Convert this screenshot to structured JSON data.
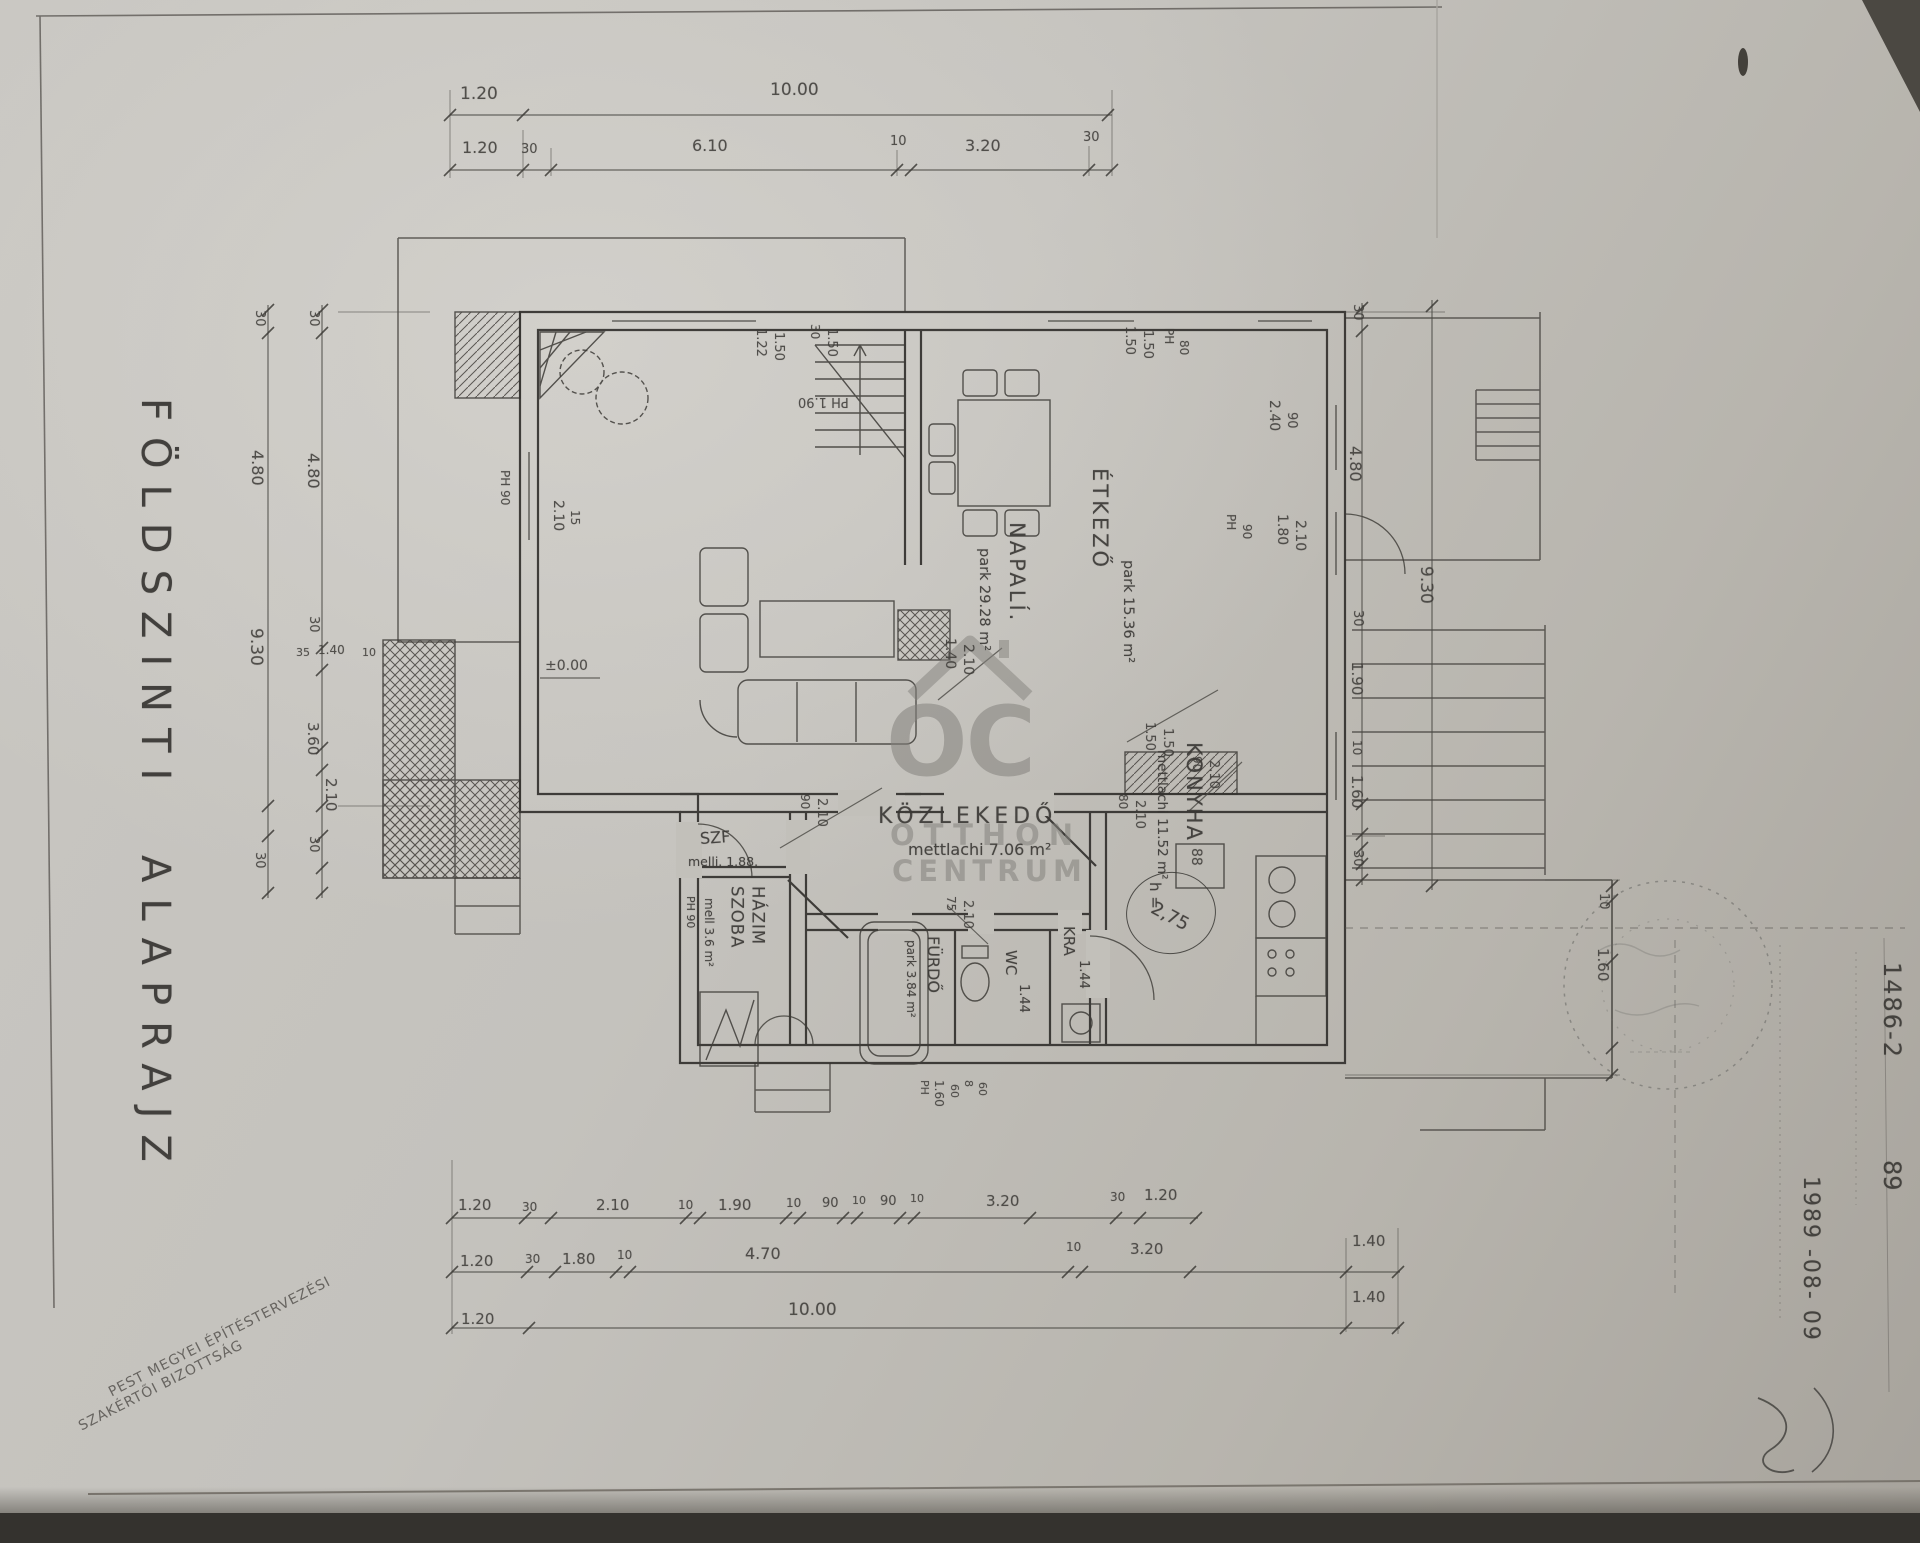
{
  "document": {
    "plan_title": "FÖLDSZINTI ALAPRAJZ",
    "committee_line1": "PEST MEGYEI ÉPÍTÉSTERVEZÉSI",
    "committee_line2": "SZAKÉRTŐI BIZOTTSÁG",
    "doc_number": "1486-2",
    "doc_number_suffix": "89",
    "date": "1989 -08- 09"
  },
  "watermark": {
    "logo": "OC",
    "line1": "OTTHON",
    "line2": "CENTRUM"
  },
  "rooms": {
    "napali": {
      "name": "NAPALÍ.",
      "area": "park 29.28 m²"
    },
    "etkezo": {
      "name": "ÉTKEZŐ",
      "area": "park 15.36 m²"
    },
    "konyha": {
      "name": "KONYHA",
      "area": "mettlachi 11.52 m²"
    },
    "kozlekedo": {
      "name": "KÖZLEKEDŐ",
      "area": "mettlachi 7.06 m²"
    },
    "furdo": {
      "name": "FÜRDŐ",
      "area": "park 3.84 m²"
    },
    "szf": {
      "name": "SZF",
      "area": "melli. 1.88."
    },
    "hazim_szoba": {
      "name": "HÁZIM SZOBA",
      "area": "mell 3.6 m²",
      "extra": "PH 90"
    },
    "wc": {
      "name": "WC",
      "area": "1.44"
    },
    "kamra": {
      "name": "KRA",
      "area": "1.44"
    }
  },
  "height_marker": {
    "label": "h =",
    "value": "2,75"
  },
  "annotations": [
    {
      "t": "1.20",
      "x": 460,
      "y": 84,
      "s": 17
    },
    {
      "t": "10.00",
      "x": 770,
      "y": 80,
      "s": 17
    },
    {
      "t": "1.20",
      "x": 462,
      "y": 138,
      "s": 16
    },
    {
      "t": "30",
      "x": 521,
      "y": 142,
      "s": 13
    },
    {
      "t": "6.10",
      "x": 692,
      "y": 136,
      "s": 16
    },
    {
      "t": "10",
      "x": 890,
      "y": 134,
      "s": 13
    },
    {
      "t": "3.20",
      "x": 965,
      "y": 136,
      "s": 16
    },
    {
      "t": "30",
      "x": 1083,
      "y": 130,
      "s": 13
    },
    {
      "t": "30",
      "x": 252,
      "y": 310,
      "r": 90,
      "s": 13
    },
    {
      "t": "30",
      "x": 306,
      "y": 310,
      "r": 90,
      "s": 13
    },
    {
      "t": "4.80",
      "x": 248,
      "y": 450,
      "r": 90,
      "s": 16
    },
    {
      "t": "4.80",
      "x": 304,
      "y": 453,
      "r": 90,
      "s": 16
    },
    {
      "t": "9.30",
      "x": 246,
      "y": 628,
      "r": 90,
      "s": 17
    },
    {
      "t": "30",
      "x": 306,
      "y": 616,
      "r": 90,
      "s": 13
    },
    {
      "t": "35",
      "x": 296,
      "y": 646,
      "s": 11
    },
    {
      "t": "1.40",
      "x": 318,
      "y": 643,
      "s": 12
    },
    {
      "t": "10",
      "x": 362,
      "y": 646,
      "s": 11
    },
    {
      "t": "3.60",
      "x": 304,
      "y": 722,
      "r": 90,
      "s": 15
    },
    {
      "t": "2.10",
      "x": 322,
      "y": 778,
      "r": 90,
      "s": 15
    },
    {
      "t": "30",
      "x": 252,
      "y": 852,
      "r": 90,
      "s": 13
    },
    {
      "t": "30",
      "x": 306,
      "y": 836,
      "r": 90,
      "s": 13
    },
    {
      "t": "30",
      "x": 1350,
      "y": 304,
      "r": 90,
      "s": 13
    },
    {
      "t": "4.80",
      "x": 1346,
      "y": 446,
      "r": 90,
      "s": 16
    },
    {
      "t": "30",
      "x": 1350,
      "y": 610,
      "r": 90,
      "s": 13
    },
    {
      "t": "1.90",
      "x": 1348,
      "y": 662,
      "r": 90,
      "s": 15
    },
    {
      "t": "10",
      "x": 1350,
      "y": 740,
      "r": 90,
      "s": 12
    },
    {
      "t": "1.60",
      "x": 1348,
      "y": 775,
      "r": 90,
      "s": 15
    },
    {
      "t": "30",
      "x": 1350,
      "y": 850,
      "r": 90,
      "s": 13
    },
    {
      "t": "9.30",
      "x": 1416,
      "y": 566,
      "r": 90,
      "s": 17
    },
    {
      "t": "10",
      "x": 1596,
      "y": 893,
      "r": 90,
      "s": 13
    },
    {
      "t": "1.60",
      "x": 1594,
      "y": 948,
      "r": 90,
      "s": 15
    },
    {
      "t": "1.20",
      "x": 458,
      "y": 1196,
      "s": 15
    },
    {
      "t": "30",
      "x": 522,
      "y": 1200,
      "s": 12
    },
    {
      "t": "2.10",
      "x": 596,
      "y": 1196,
      "s": 15
    },
    {
      "t": "10",
      "x": 678,
      "y": 1198,
      "s": 12
    },
    {
      "t": "1.90",
      "x": 718,
      "y": 1196,
      "s": 15
    },
    {
      "t": "10",
      "x": 786,
      "y": 1196,
      "s": 12
    },
    {
      "t": "90",
      "x": 822,
      "y": 1196,
      "s": 13
    },
    {
      "t": "10",
      "x": 852,
      "y": 1194,
      "s": 11
    },
    {
      "t": "90",
      "x": 880,
      "y": 1194,
      "s": 13
    },
    {
      "t": "10",
      "x": 910,
      "y": 1192,
      "s": 11
    },
    {
      "t": "3.20",
      "x": 986,
      "y": 1192,
      "s": 15
    },
    {
      "t": "30",
      "x": 1110,
      "y": 1190,
      "s": 12
    },
    {
      "t": "1.20",
      "x": 1144,
      "y": 1186,
      "s": 15
    },
    {
      "t": "1.20",
      "x": 460,
      "y": 1252,
      "s": 15
    },
    {
      "t": "30",
      "x": 525,
      "y": 1252,
      "s": 12
    },
    {
      "t": "1.80",
      "x": 562,
      "y": 1250,
      "s": 15
    },
    {
      "t": "10",
      "x": 617,
      "y": 1248,
      "s": 12
    },
    {
      "t": "4.70",
      "x": 745,
      "y": 1244,
      "s": 16
    },
    {
      "t": "10",
      "x": 1066,
      "y": 1240,
      "s": 12
    },
    {
      "t": "3.20",
      "x": 1130,
      "y": 1240,
      "s": 15
    },
    {
      "t": "1.40",
      "x": 1352,
      "y": 1232,
      "s": 15
    },
    {
      "t": "1.20",
      "x": 461,
      "y": 1310,
      "s": 15
    },
    {
      "t": "10.00",
      "x": 788,
      "y": 1300,
      "s": 17
    },
    {
      "t": "1.40",
      "x": 1352,
      "y": 1288,
      "s": 15
    },
    {
      "t": "1.22",
      "x": 753,
      "y": 328,
      "r": 90,
      "s": 13
    },
    {
      "t": "1.50",
      "x": 771,
      "y": 332,
      "r": 90,
      "s": 13
    },
    {
      "t": "30",
      "x": 808,
      "y": 324,
      "r": 90,
      "s": 12
    },
    {
      "t": "1.50",
      "x": 824,
      "y": 328,
      "r": 90,
      "s": 13
    },
    {
      "t": "PH 1.90",
      "x": 798,
      "y": 394,
      "r": 180,
      "s": 13
    },
    {
      "t": "1.50",
      "x": 1122,
      "y": 326,
      "r": 90,
      "s": 13
    },
    {
      "t": "1.50",
      "x": 1140,
      "y": 330,
      "r": 90,
      "s": 13
    },
    {
      "t": "PH",
      "x": 1162,
      "y": 328,
      "r": 90,
      "s": 12
    },
    {
      "t": "80",
      "x": 1177,
      "y": 340,
      "r": 90,
      "s": 12
    },
    {
      "t": "2.40",
      "x": 1266,
      "y": 400,
      "r": 90,
      "s": 14
    },
    {
      "t": "90",
      "x": 1284,
      "y": 412,
      "r": 90,
      "s": 13
    },
    {
      "t": "PH",
      "x": 1224,
      "y": 514,
      "r": 90,
      "s": 12
    },
    {
      "t": "90",
      "x": 1240,
      "y": 524,
      "r": 90,
      "s": 12
    },
    {
      "t": "1.80",
      "x": 1274,
      "y": 514,
      "r": 90,
      "s": 14
    },
    {
      "t": "2.10",
      "x": 1292,
      "y": 520,
      "r": 90,
      "s": 14
    },
    {
      "t": "2.10",
      "x": 550,
      "y": 500,
      "r": 90,
      "s": 14
    },
    {
      "t": "15",
      "x": 568,
      "y": 510,
      "r": 90,
      "s": 12
    },
    {
      "t": "PH 90",
      "x": 498,
      "y": 470,
      "r": 90,
      "s": 12
    },
    {
      "t": "±0.00",
      "x": 545,
      "y": 658,
      "s": 14
    },
    {
      "t": "1.40",
      "x": 942,
      "y": 638,
      "r": 90,
      "s": 14
    },
    {
      "t": "2.10",
      "x": 960,
      "y": 644,
      "r": 90,
      "s": 14
    },
    {
      "t": "90",
      "x": 798,
      "y": 794,
      "r": 90,
      "s": 12
    },
    {
      "t": "2.10",
      "x": 814,
      "y": 798,
      "r": 90,
      "s": 13
    },
    {
      "t": "1.50",
      "x": 1142,
      "y": 722,
      "r": 90,
      "s": 13
    },
    {
      "t": "1.50",
      "x": 1160,
      "y": 728,
      "r": 90,
      "s": 13
    },
    {
      "t": "90",
      "x": 1190,
      "y": 756,
      "r": 90,
      "s": 12
    },
    {
      "t": "2.10",
      "x": 1206,
      "y": 760,
      "r": 90,
      "s": 13
    },
    {
      "t": "80",
      "x": 1116,
      "y": 794,
      "r": 90,
      "s": 12
    },
    {
      "t": "2.10",
      "x": 1132,
      "y": 800,
      "r": 90,
      "s": 13
    },
    {
      "t": "75",
      "x": 944,
      "y": 896,
      "r": 90,
      "s": 12
    },
    {
      "t": "2.10",
      "x": 960,
      "y": 900,
      "r": 90,
      "s": 13
    },
    {
      "t": "88",
      "x": 1188,
      "y": 848,
      "r": 90,
      "s": 14
    },
    {
      "t": "PH",
      "x": 918,
      "y": 1080,
      "r": 90,
      "s": 11
    },
    {
      "t": "1.60",
      "x": 932,
      "y": 1080,
      "r": 90,
      "s": 12
    },
    {
      "t": "60",
      "x": 948,
      "y": 1084,
      "r": 90,
      "s": 11
    },
    {
      "t": "8",
      "x": 962,
      "y": 1080,
      "r": 90,
      "s": 11
    },
    {
      "t": "60",
      "x": 976,
      "y": 1082,
      "r": 90,
      "s": 11
    }
  ]
}
